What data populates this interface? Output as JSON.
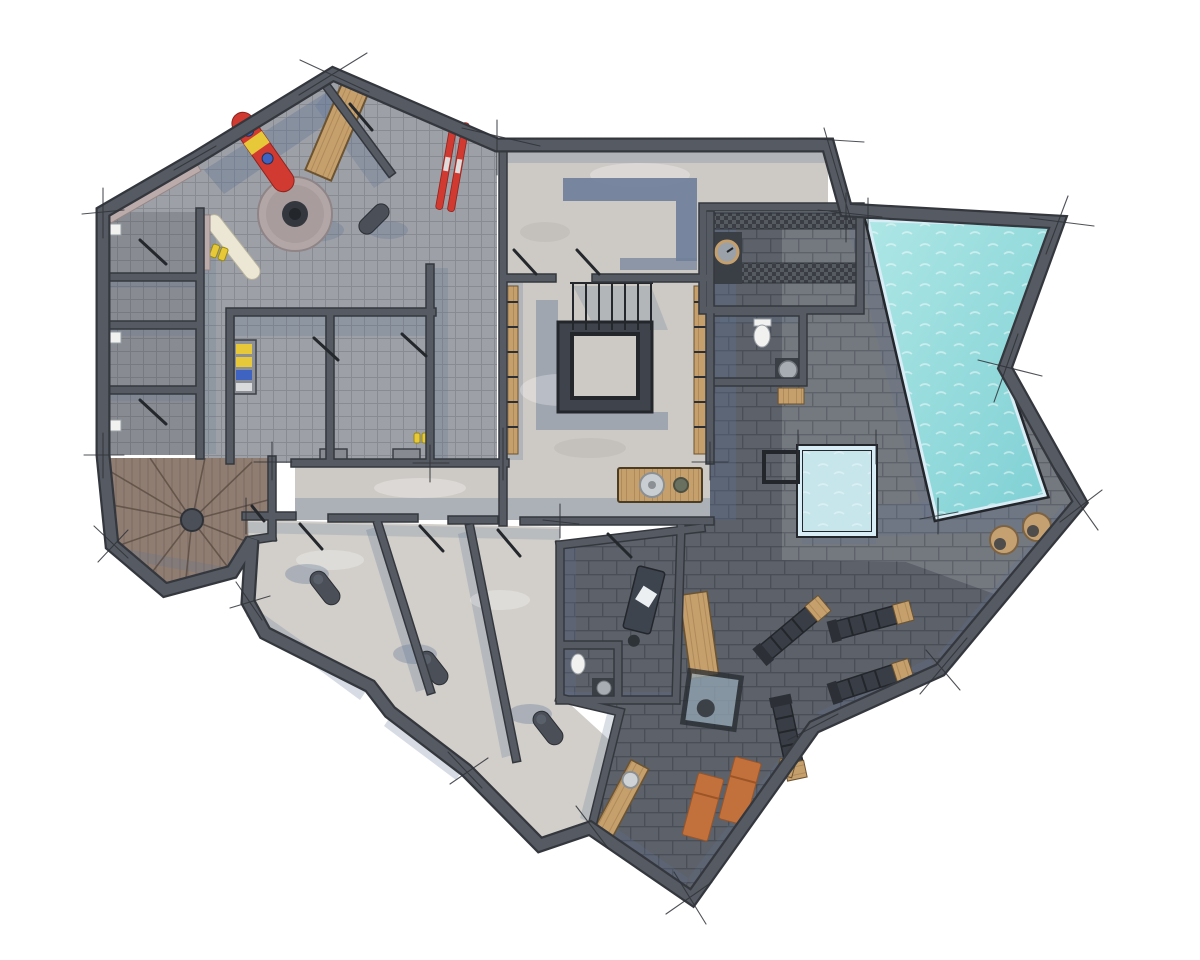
{
  "document": {
    "type": "architectural-floor-plan",
    "style": "rendered top-down plan with sketch overshoot lines",
    "level": "spa-and-ski basement level",
    "canvas": {
      "width": 1200,
      "height": 960,
      "background": "#ffffff"
    }
  },
  "palette": {
    "bg": "#ffffff",
    "wall": "#565a62",
    "wall-dark": "#34383e",
    "frame": "#23262b",
    "sketch": "#2f3338",
    "leaf": "#24282d",
    "tile-floor": "#9da0a6",
    "tile-line": "#888b91",
    "concrete": "#cdcac5",
    "concrete-light": "#d2cfca",
    "shadow": "rgba(96,116,148,0.42)",
    "slate-wall": "#70809a",
    "brick-deck": "#74787f",
    "brick-deck-line": "#5e626a",
    "brick-gym": "#5d616a",
    "brick-gym-line": "#4a4e57",
    "pool-water-1": "#a9e3e3",
    "pool-water-2": "#7fd0d4",
    "pool-rim": "#d8edf6",
    "plunge-water": "#c6e6ec",
    "wood": "#c5a06c",
    "wood-line": "#a07c4e",
    "wood-stairs": "#8f7d72",
    "wood-stairs-line": "#6f6057",
    "checker-a": "#3a3e44",
    "checker-b": "#565b62",
    "lounger": "#c2713c",
    "equipment": "#393e46",
    "column": "#4a4f58",
    "accent-red": "#d03a31",
    "accent-yellow": "#e6c838",
    "accent-blue": "#3f63c0",
    "cream": "#ece7d4",
    "stool": "#c5a171",
    "bench-pink": "#bcabab",
    "white-fixture": "#f1f2f0"
  },
  "zones": [
    {
      "id": "ski-room",
      "floor": "grey-tile"
    },
    {
      "id": "storage-rooms-left",
      "floor": "grey-tile-dark",
      "count": 3
    },
    {
      "id": "winder-staircase",
      "floor": "wood"
    },
    {
      "id": "technical-room-top",
      "floor": "concrete"
    },
    {
      "id": "stair-hall",
      "floor": "concrete",
      "feature": "central-void-with-railing"
    },
    {
      "id": "corridor",
      "floor": "concrete"
    },
    {
      "id": "bedrooms",
      "floor": "light-concrete",
      "count": 3
    },
    {
      "id": "massage-room",
      "floor": "dark-brick"
    },
    {
      "id": "sauna",
      "floor": "dark-brick",
      "feature": "grate-strips"
    },
    {
      "id": "wc",
      "floor": "dark-brick"
    },
    {
      "id": "gym",
      "floor": "dark-brick",
      "machines": 4
    },
    {
      "id": "pool-deck",
      "floor": "grey-brick"
    }
  ],
  "water": {
    "main-pool": {
      "shape": "tapered-quad",
      "color": "turquoise"
    },
    "plunge-pool": {
      "shape": "square",
      "color": "ice-blue"
    }
  },
  "furniture": [
    "red-snowboard",
    "cream-snowboard",
    "red-skis",
    "ski-boots",
    "boot-dryer-round",
    "wood-bench-diagonal",
    "pink-wall-bench",
    "boot-shelf",
    "corridor-benches",
    "dark-pouf",
    "wood-slat-columns",
    "stair-railing",
    "vanity-basin",
    "toilet",
    "sauna-basin-clock",
    "wood-stool",
    "massage-table-with-towel",
    "wc-toilet",
    "wc-basin",
    "sideboard-with-tray-and-plant",
    "glass-side-table",
    "gym-machine-1",
    "gym-machine-2",
    "gym-machine-3",
    "gym-machine-4",
    "wood-gym-bench",
    "wood-tail-bench",
    "wood-mats",
    "lounger-1",
    "lounger-2",
    "wicker-stool-1",
    "wicker-stool-2",
    "bedroom-column-1",
    "bedroom-column-2",
    "bedroom-column-3"
  ]
}
